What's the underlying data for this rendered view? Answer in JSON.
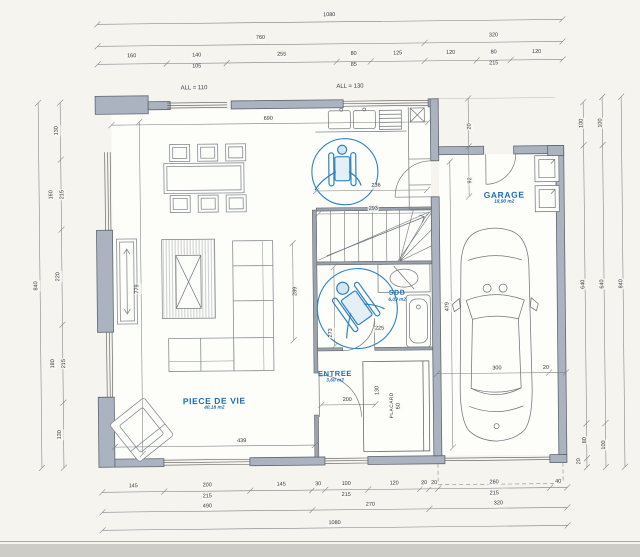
{
  "colors": {
    "accent_blue": "#2f82c0",
    "label_blue": "#1d6db5",
    "wall_gray": "#aab3bf",
    "paper": "#f5f4ef",
    "line_gray": "#6a6f76"
  },
  "rooms": [
    {
      "name": "PIECE DE VIE",
      "area": "40,18 m2",
      "x": 213,
      "y": 400,
      "fs": 8.5
    },
    {
      "name": "ENTREE",
      "area": "3,60 m2",
      "x": 334,
      "y": 374,
      "fs": 7.5
    },
    {
      "name": "SDB",
      "area": "6,09 m2",
      "x": 397,
      "y": 294,
      "fs": 7
    },
    {
      "name": "GARAGE",
      "area": "18,90 m2",
      "x": 505,
      "y": 197,
      "fs": 8.5
    }
  ],
  "window_labels": [
    {
      "text": "ALL = 110",
      "x": 196,
      "y": 87
    },
    {
      "text": "ALL = 130",
      "x": 352,
      "y": 87
    }
  ],
  "closet_label": {
    "text": "PLACARD",
    "x": 392,
    "y": 406
  },
  "dimensions": [
    {
      "t": "1080",
      "x": 332,
      "y": 16
    },
    {
      "t": "760",
      "x": 263,
      "y": 38
    },
    {
      "t": "320",
      "x": 496,
      "y": 38
    },
    {
      "t": "160",
      "x": 134,
      "y": 55
    },
    {
      "t": "140",
      "x": 199,
      "y": 55
    },
    {
      "t": "105",
      "x": 199,
      "y": 66
    },
    {
      "t": "255",
      "x": 284,
      "y": 55
    },
    {
      "t": "80",
      "x": 356,
      "y": 55
    },
    {
      "t": "85",
      "x": 356,
      "y": 66
    },
    {
      "t": "125",
      "x": 400,
      "y": 55
    },
    {
      "t": "120",
      "x": 453,
      "y": 55
    },
    {
      "t": "80",
      "x": 496,
      "y": 55
    },
    {
      "t": "215",
      "x": 496,
      "y": 66
    },
    {
      "t": "120",
      "x": 539,
      "y": 55
    },
    {
      "t": "840",
      "x": 37,
      "y": 283,
      "r": -90
    },
    {
      "t": "130",
      "x": 59,
      "y": 128,
      "r": -90
    },
    {
      "t": "160",
      "x": 53,
      "y": 192,
      "r": -90
    },
    {
      "t": "215",
      "x": 64,
      "y": 192,
      "r": -90
    },
    {
      "t": "220",
      "x": 59,
      "y": 274,
      "r": -90
    },
    {
      "t": "180",
      "x": 53,
      "y": 361,
      "r": -90
    },
    {
      "t": "215",
      "x": 64,
      "y": 361,
      "r": -90
    },
    {
      "t": "130",
      "x": 59,
      "y": 432,
      "r": -90
    },
    {
      "t": "100",
      "x": 584,
      "y": 126,
      "r": -90
    },
    {
      "t": "640",
      "x": 584,
      "y": 287,
      "r": -90
    },
    {
      "t": "80",
      "x": 584,
      "y": 443,
      "r": -90
    },
    {
      "t": "20",
      "x": 578,
      "y": 464,
      "r": -90
    },
    {
      "t": "100",
      "x": 603,
      "y": 126,
      "r": -90
    },
    {
      "t": "640",
      "x": 603,
      "y": 287,
      "r": -90
    },
    {
      "t": "100",
      "x": 603,
      "y": 448,
      "r": -90
    },
    {
      "t": "840",
      "x": 622,
      "y": 287,
      "r": -90
    },
    {
      "t": "145",
      "x": 131,
      "y": 485
    },
    {
      "t": "200",
      "x": 205,
      "y": 485
    },
    {
      "t": "215",
      "x": 205,
      "y": 496
    },
    {
      "t": "145",
      "x": 279,
      "y": 485
    },
    {
      "t": "30",
      "x": 316,
      "y": 485
    },
    {
      "t": "100",
      "x": 344,
      "y": 485
    },
    {
      "t": "215",
      "x": 344,
      "y": 496
    },
    {
      "t": "120",
      "x": 392,
      "y": 485
    },
    {
      "t": "20",
      "x": 422,
      "y": 485
    },
    {
      "t": "20",
      "x": 432,
      "y": 485
    },
    {
      "t": "260",
      "x": 492,
      "y": 485
    },
    {
      "t": "215",
      "x": 492,
      "y": 496
    },
    {
      "t": "40",
      "x": 556,
      "y": 485
    },
    {
      "t": "490",
      "x": 205,
      "y": 506
    },
    {
      "t": "270",
      "x": 368,
      "y": 506
    },
    {
      "t": "320",
      "x": 496,
      "y": 506
    },
    {
      "t": "1080",
      "x": 332,
      "y": 524
    },
    {
      "t": "690",
      "x": 270,
      "y": 119
    },
    {
      "t": "779",
      "x": 138,
      "y": 287,
      "r": -90
    },
    {
      "t": "289",
      "x": 296,
      "y": 291,
      "r": -90
    },
    {
      "t": "236",
      "x": 377,
      "y": 187
    },
    {
      "t": "293",
      "x": 374,
      "y": 210
    },
    {
      "t": "273",
      "x": 331,
      "y": 333,
      "r": -90
    },
    {
      "t": "225",
      "x": 379,
      "y": 330
    },
    {
      "t": "200",
      "x": 346,
      "y": 401
    },
    {
      "t": "130",
      "x": 377,
      "y": 391,
      "r": -90
    },
    {
      "t": "60",
      "x": 398,
      "y": 407,
      "r": -90
    },
    {
      "t": "439",
      "x": 240,
      "y": 441
    },
    {
      "t": "479",
      "x": 448,
      "y": 308,
      "r": -90
    },
    {
      "t": "300",
      "x": 496,
      "y": 371
    },
    {
      "t": "20",
      "x": 545,
      "y": 371
    },
    {
      "t": "20",
      "x": 472,
      "y": 128,
      "r": -90
    },
    {
      "t": "92",
      "x": 472,
      "y": 182,
      "r": -90
    }
  ]
}
